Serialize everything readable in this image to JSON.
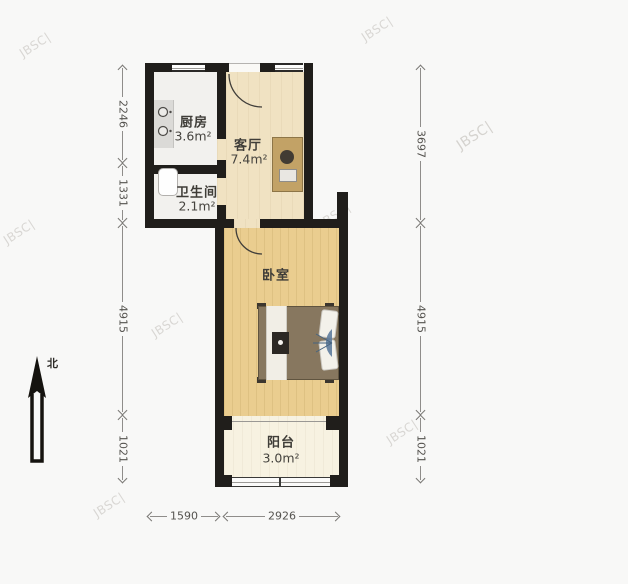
{
  "compass": {
    "label": "北"
  },
  "watermark": {
    "text": "JBSC|"
  },
  "rooms": {
    "kitchen": {
      "label": "厨房",
      "area": "3.6m²"
    },
    "bathroom": {
      "label": "卫生间",
      "area": "2.1m²"
    },
    "living": {
      "label": "客厅",
      "area": "7.4m²"
    },
    "bedroom": {
      "label": "卧室"
    },
    "balcony": {
      "label": "阳台",
      "area": "3.0m²"
    }
  },
  "dimensions": {
    "left": [
      "2246",
      "1331",
      "4915",
      "1021"
    ],
    "right": [
      "3697",
      "4915",
      "1021"
    ],
    "bottom": [
      "1590",
      "2926"
    ]
  },
  "colors": {
    "wall": "#201e1b",
    "bedroom_floor": "#eacd8f",
    "living_floor": "#f0e2c2",
    "balcony_floor": "#f7f2e1",
    "tile_floor": "#f2f1ee",
    "dim_text": "#55534f"
  }
}
